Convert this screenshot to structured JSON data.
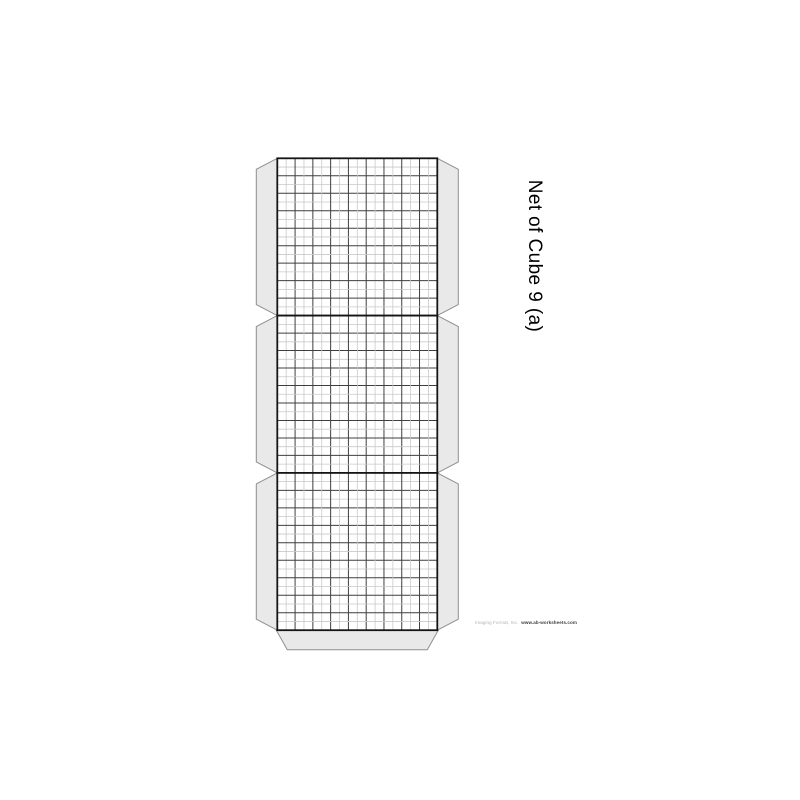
{
  "document": {
    "title": "Net of Cube 9 (a)",
    "footer_left": "Imaging Format, Inc.",
    "footer_right": "www.ab-worksheets.com"
  },
  "net": {
    "description": "strip of 3 square cube faces with glue tabs",
    "face_count": 3,
    "cells_per_side": 9,
    "subdivisions_per_cell": 2,
    "face_left": 277.3,
    "face_top": 158.3,
    "face_width": 160,
    "face_height": 157.3,
    "side_tab_width": 21,
    "side_tab_chamfer": 11,
    "bottom_tab_height": 19.5,
    "bottom_tab_inset": 10
  },
  "colors": {
    "page_bg": "#ffffff",
    "tab_fill": "#e9e9e9",
    "tab_border": "#8f8f8f",
    "face_fill": "#ffffff",
    "face_border": "#151515",
    "grid_major": "#3f3f3f",
    "grid_minor": "#c9c9c9",
    "title_color": "#000000",
    "footer_left_color": "#b3b3b3",
    "footer_right_color": "#3c3c3c"
  }
}
